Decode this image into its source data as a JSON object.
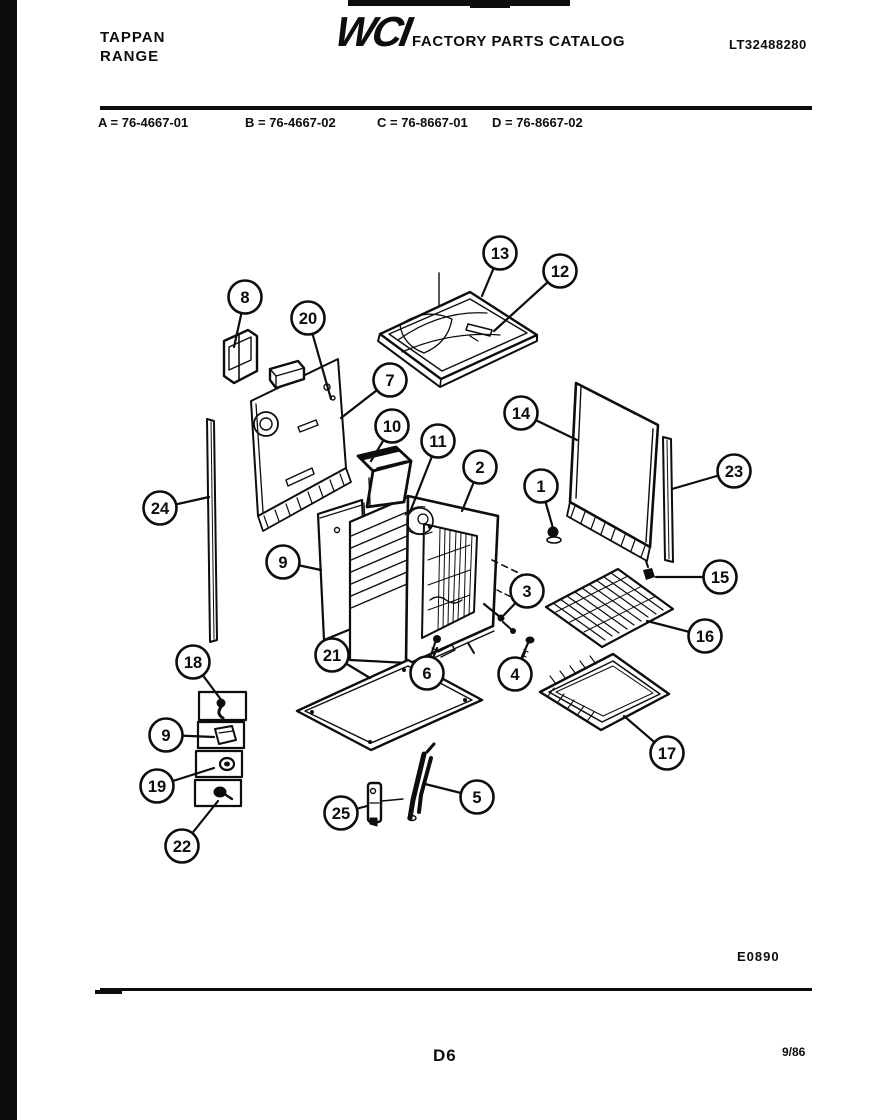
{
  "header": {
    "brand": "TAPPAN\nRANGE",
    "logo": "WCI",
    "title": "FACTORY PARTS CATALOG",
    "doc_number": "LT32488280"
  },
  "model_legend": {
    "items": [
      "A = 76-4667-01",
      "B = 76-4667-02",
      "C = 76-8667-01",
      "D = 76-8667-02"
    ]
  },
  "footer": {
    "form_code": "E0890",
    "page_number": "D6",
    "date": "9/86"
  },
  "diagram": {
    "description": "Exploded parts view of range body and oven cabinet",
    "callout_style": {
      "radius": 16.5,
      "stroke": "#0d0d0d",
      "fill": "#ffffff",
      "font_size": 16.5
    },
    "callouts": [
      {
        "n": "8",
        "cx": 245,
        "cy": 297,
        "tx": 234,
        "ty": 347
      },
      {
        "n": "20",
        "cx": 308,
        "cy": 318,
        "tx": 331,
        "ty": 399
      },
      {
        "n": "13",
        "cx": 500,
        "cy": 253,
        "tx": 482,
        "ty": 296
      },
      {
        "n": "12",
        "cx": 560,
        "cy": 271,
        "tx": 494,
        "ty": 331
      },
      {
        "n": "7",
        "cx": 390,
        "cy": 380,
        "tx": 341,
        "ty": 418
      },
      {
        "n": "10",
        "cx": 392,
        "cy": 426,
        "tx": 371,
        "ty": 461
      },
      {
        "n": "11",
        "cx": 438,
        "cy": 441,
        "tx": 410,
        "ty": 512
      },
      {
        "n": "2",
        "cx": 480,
        "cy": 467,
        "tx": 462,
        "ty": 511
      },
      {
        "n": "14",
        "cx": 521,
        "cy": 413,
        "tx": 577,
        "ty": 440
      },
      {
        "n": "1",
        "cx": 541,
        "cy": 486,
        "tx": 553,
        "ty": 528
      },
      {
        "n": "23",
        "cx": 734,
        "cy": 471,
        "tx": 672,
        "ty": 489
      },
      {
        "n": "24",
        "cx": 160,
        "cy": 508,
        "tx": 209,
        "ty": 497
      },
      {
        "n": "9",
        "cx": 283,
        "cy": 562,
        "tx": 321,
        "ty": 570
      },
      {
        "n": "3",
        "cx": 527,
        "cy": 591,
        "tx": 504,
        "ty": 615
      },
      {
        "n": "15",
        "cx": 720,
        "cy": 577,
        "tx": 656,
        "ty": 577
      },
      {
        "n": "16",
        "cx": 705,
        "cy": 636,
        "tx": 647,
        "ty": 621
      },
      {
        "n": "21",
        "cx": 332,
        "cy": 655,
        "tx": 370,
        "ty": 678
      },
      {
        "n": "6",
        "cx": 427,
        "cy": 673,
        "tx": 437,
        "ty": 648
      },
      {
        "n": "4",
        "cx": 515,
        "cy": 674,
        "tx": 525,
        "ty": 652
      },
      {
        "n": "17",
        "cx": 667,
        "cy": 753,
        "tx": 624,
        "ty": 716
      },
      {
        "n": "18",
        "cx": 193,
        "cy": 662,
        "tx": 222,
        "ty": 701
      },
      {
        "n": "9",
        "cx": 166,
        "cy": 735,
        "tx": 214,
        "ty": 737
      },
      {
        "n": "19",
        "cx": 157,
        "cy": 786,
        "tx": 214,
        "ty": 768
      },
      {
        "n": "22",
        "cx": 182,
        "cy": 846,
        "tx": 218,
        "ty": 801
      },
      {
        "n": "25",
        "cx": 341,
        "cy": 813,
        "tx": 367,
        "ty": 806
      },
      {
        "n": "5",
        "cx": 477,
        "cy": 797,
        "tx": 425,
        "ty": 784
      }
    ]
  }
}
